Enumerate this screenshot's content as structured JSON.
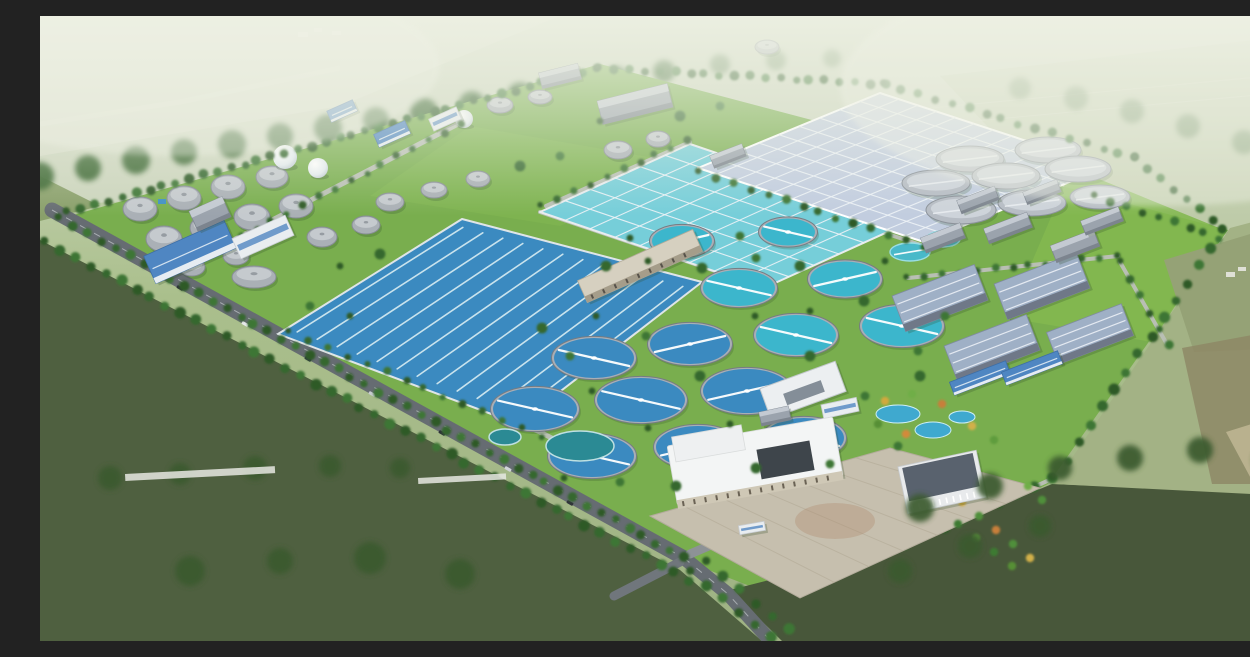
{
  "scene": {
    "label": "Aerial architectural rendering of a large wastewater treatment plant campus surrounded by green farmland",
    "time_of_day": "day",
    "no_visible_text": true
  },
  "colors": {
    "haze": "#eef1e4",
    "distant_field": "#ccd5bd",
    "distant_field2": "#d6dcc8",
    "right_far": "#bfcbaa",
    "site_grass": "#79ae4e",
    "lawn": "#83b850",
    "field_dark_left": "#4f6040",
    "field_dark_right": "#48573a",
    "field_right": "#a3b285",
    "farm_rows": "#95a276",
    "brown_field": "#8e8866",
    "tan_field": "#c0b794",
    "road_dark": "#666c72",
    "road_mid": "#8d9296",
    "road_light": "#b9bfb4",
    "water_blue": "#3b8ac0",
    "water_cyan": "#3cb6cc",
    "aeration": "#76ced9",
    "covered_roof": "#c2cddf",
    "pond_teal": "#2b8a94",
    "garden_pond": "#3fa9cf",
    "tank_gray": "#aab0b6",
    "tank_dome": "#c6cbd0",
    "tank_flat": "#b6bcc4",
    "tank_flat_top": "#cdd3da",
    "sphere": "#eef2f4",
    "roof_blue": "#4f86c2",
    "bld_white": "#e9edf0",
    "bld_gray": "#9ba3ad",
    "bld_beige": "#d6d0c0",
    "workshop_roof": "#9fb0c6",
    "admin_roof": "#f3f5f5",
    "admin_dark_roof": "#59626e",
    "plaza": "#c6bfae",
    "tree_a": "#2d5a28",
    "tree_b": "#35682e",
    "tree_c": "#3e7634",
    "clump": "#39652f",
    "clump_front": "#3a5a2e"
  },
  "background_back": [
    {
      "name": "distant-band",
      "pts": "0,0 1250,0 1250,120 0,190",
      "fill": "#ccd5bd",
      "op": 1
    },
    {
      "name": "distant-topleft",
      "pts": "0,0 520,0 300,90 0,140",
      "fill": "#d6dcc8",
      "op": 1
    },
    {
      "name": "distant-right",
      "pts": "900,60 1250,20 1250,240 1060,230",
      "fill": "#bfcbaa",
      "op": 0.9
    },
    {
      "name": "midleft-wedge",
      "pts": "0,160 60,190 0,205",
      "fill": "#8aa06b",
      "op": 1
    }
  ],
  "background_front": [
    {
      "name": "field-left",
      "pts": "0,224 640,554 722,625 0,625",
      "fill": "#4f6040",
      "op": 1
    },
    {
      "name": "field-bottom-right",
      "pts": "742,625 690,574 864,530 1012,468 1250,478 1250,625",
      "fill": "#48573a",
      "op": 1
    },
    {
      "name": "field-right",
      "pts": "1190,212 1250,196 1250,480 1014,468",
      "fill": "#a3b285",
      "op": 1
    },
    {
      "name": "farm-rows",
      "pts": "1124,244 1250,206 1250,332 1154,336",
      "fill": "#95a276",
      "op": 1
    },
    {
      "name": "field-brown",
      "pts": "1142,332 1250,312 1250,468 1172,468",
      "fill": "#8e8866",
      "op": 0.85
    },
    {
      "name": "field-tan",
      "pts": "1186,416 1250,396 1250,470 1216,472",
      "fill": "#c0b794",
      "op": 0.85
    }
  ],
  "site": {
    "pts": "30,200 560,48 1188,214 1008,468 756,588 648,546",
    "fill": "#79ae4e"
  },
  "lawns": [
    {
      "pts": "1032,152 1184,214 1112,326 968,302",
      "fill": "#83b850",
      "op": 0.9
    },
    {
      "pts": "430,110 660,150 520,210 330,180",
      "fill": "#84b751",
      "op": 0.5
    }
  ],
  "light_roads": [
    {
      "pts": [
        [
          120,
          262
        ],
        [
          422,
          106
        ]
      ],
      "w": 5
    },
    {
      "pts": [
        [
          252,
          312
        ],
        [
          500,
          416
        ],
        [
          562,
          448
        ]
      ],
      "w": 5
    },
    {
      "pts": [
        [
          500,
          196
        ],
        [
          726,
          272
        ]
      ],
      "w": 4
    },
    {
      "pts": [
        [
          506,
          190
        ],
        [
          650,
          126
        ]
      ],
      "w": 4
    },
    {
      "pts": [
        [
          660,
          156
        ],
        [
          884,
          230
        ]
      ],
      "w": 4
    },
    {
      "pts": [
        [
          868,
          262
        ],
        [
          1078,
          240
        ]
      ],
      "w": 4
    },
    {
      "pts": [
        [
          1080,
          246
        ],
        [
          1128,
          330
        ]
      ],
      "w": 4
    },
    {
      "pts": [
        [
          866,
          528
        ],
        [
          1014,
          462
        ]
      ],
      "w": 4
    }
  ],
  "dark_roads": [
    {
      "pts": [
        [
          12,
          194
        ],
        [
          644,
          542
        ]
      ],
      "w": 15,
      "c": "#666c72",
      "dash": true
    },
    {
      "pts": [
        [
          644,
          542
        ],
        [
          688,
          578
        ],
        [
          728,
          622
        ]
      ],
      "w": 14,
      "c": "#666c72",
      "dash": true
    },
    {
      "pts": [
        [
          650,
          538
        ],
        [
          706,
          514
        ]
      ],
      "w": 9,
      "c": "#8d9296",
      "dash": false
    },
    {
      "pts": [
        [
          640,
          546
        ],
        [
          574,
          580
        ]
      ],
      "w": 9,
      "c": "#70767c",
      "dash": false
    }
  ],
  "cars": [
    [
      140,
      272
    ],
    [
      205,
      308
    ],
    [
      268,
      343
    ],
    [
      332,
      378
    ],
    [
      402,
      417
    ],
    [
      468,
      453
    ],
    [
      530,
      487
    ]
  ],
  "car_colors": [
    "#2e3238",
    "#e8eaec",
    "#303840",
    "#c8ccd0",
    "#2e3238",
    "#d0d4d8",
    "#30343a"
  ],
  "basins": [
    {
      "name": "oxidation-ditch-basin",
      "quad": [
        [
          238,
          318
        ],
        [
          422,
          203
        ],
        [
          662,
          266
        ],
        [
          478,
          408
        ]
      ],
      "fill": "#3b8ac0",
      "style": "serpentine",
      "n": 12,
      "rim": "#dfe5e8"
    },
    {
      "name": "aeration-basin",
      "quad": [
        [
          500,
          196
        ],
        [
          650,
          128
        ],
        [
          874,
          204
        ],
        [
          724,
          272
        ]
      ],
      "fill": "#76ced9",
      "style": "grid",
      "n1": 6,
      "n2": 9,
      "rim": "#e8ecef"
    },
    {
      "name": "covered-basin",
      "quad": [
        [
          658,
          152
        ],
        [
          840,
          77
        ],
        [
          1066,
          151
        ],
        [
          884,
          226
        ]
      ],
      "fill": "#c2cddf",
      "style": "grid",
      "n1": 9,
      "n2": 12,
      "rim": "#ffffff"
    }
  ],
  "gray_tanks": [
    [
      100,
      193,
      17,
      12
    ],
    [
      144,
      182,
      17,
      12
    ],
    [
      188,
      171,
      17,
      12
    ],
    [
      232,
      161,
      16,
      11
    ],
    [
      124,
      223,
      18,
      13
    ],
    [
      168,
      212,
      18,
      13
    ],
    [
      212,
      201,
      18,
      13
    ],
    [
      256,
      190,
      17,
      12
    ],
    [
      152,
      251,
      13,
      9
    ],
    [
      196,
      240,
      13,
      9
    ],
    [
      282,
      221,
      15,
      10
    ],
    [
      326,
      209,
      14,
      9
    ],
    [
      350,
      186,
      14,
      9
    ],
    [
      394,
      174,
      13,
      8
    ],
    [
      438,
      163,
      12,
      8
    ],
    [
      460,
      89,
      13,
      8
    ],
    [
      500,
      81,
      12,
      7
    ],
    [
      727,
      31,
      12,
      7
    ],
    [
      578,
      134,
      14,
      9
    ],
    [
      618,
      123,
      12,
      8
    ],
    [
      214,
      261,
      22,
      11
    ]
  ],
  "flat_tanks": [
    [
      930,
      143,
      34,
      13
    ],
    [
      1008,
      134,
      33,
      13
    ],
    [
      896,
      167,
      34,
      13
    ],
    [
      966,
      160,
      34,
      13
    ],
    [
      1038,
      153,
      33,
      13
    ],
    [
      921,
      194,
      35,
      14
    ],
    [
      992,
      187,
      34,
      13
    ],
    [
      1060,
      181,
      30,
      12
    ]
  ],
  "cyan_tanks": [
    [
      870,
      236,
      20,
      9
    ],
    [
      903,
      223,
      17,
      8
    ]
  ],
  "spheres": [
    [
      245,
      141,
      12
    ],
    [
      278,
      152,
      10
    ],
    [
      424,
      103,
      9
    ]
  ],
  "clarifiers": [
    [
      642,
      225,
      30,
      "c"
    ],
    [
      748,
      216,
      27,
      "c"
    ],
    [
      699,
      272,
      36,
      "c"
    ],
    [
      805,
      263,
      35,
      "c"
    ],
    [
      756,
      319,
      40,
      "c"
    ],
    [
      862,
      310,
      40,
      "c"
    ],
    [
      650,
      328,
      40,
      "b"
    ],
    [
      554,
      342,
      40,
      "b"
    ],
    [
      601,
      384,
      44,
      "b"
    ],
    [
      707,
      375,
      44,
      "b"
    ],
    [
      495,
      393,
      42,
      "b"
    ],
    [
      552,
      440,
      42,
      "b"
    ],
    [
      658,
      431,
      42,
      "b"
    ],
    [
      764,
      422,
      40,
      "b"
    ]
  ],
  "buildings": [
    [
      150,
      236,
      88,
      30,
      -24,
      "blue"
    ],
    [
      223,
      221,
      58,
      22,
      -24,
      "white"
    ],
    [
      170,
      198,
      36,
      22,
      -24,
      "gray"
    ],
    [
      352,
      118,
      34,
      14,
      -24,
      "blue"
    ],
    [
      405,
      103,
      30,
      13,
      -24,
      "white"
    ],
    [
      302,
      95,
      28,
      12,
      -24,
      "blue"
    ],
    [
      595,
      88,
      72,
      24,
      -14,
      "gray"
    ],
    [
      520,
      60,
      40,
      16,
      -14,
      "gray"
    ],
    [
      600,
      250,
      126,
      24,
      -24,
      "beige"
    ],
    [
      688,
      140,
      34,
      13,
      -21,
      "gray"
    ],
    [
      763,
      374,
      80,
      32,
      -20,
      "ubld"
    ],
    [
      900,
      282,
      88,
      38,
      -21,
      "workshop"
    ],
    [
      1002,
      270,
      88,
      38,
      -21,
      "workshop"
    ],
    [
      952,
      332,
      88,
      38,
      -21,
      "workshop"
    ],
    [
      1050,
      318,
      80,
      34,
      -21,
      "workshop"
    ],
    [
      1035,
      230,
      46,
      18,
      -21,
      "gray"
    ],
    [
      968,
      212,
      46,
      16,
      -21,
      "gray"
    ],
    [
      903,
      222,
      42,
      16,
      -21,
      "gray"
    ],
    [
      938,
      184,
      40,
      14,
      -21,
      "gray"
    ],
    [
      1002,
      176,
      36,
      13,
      -21,
      "gray"
    ],
    [
      1062,
      205,
      40,
      15,
      -21,
      "gray"
    ],
    [
      940,
      362,
      60,
      14,
      -21,
      "blue"
    ],
    [
      992,
      352,
      60,
      14,
      -21,
      "blue"
    ],
    [
      735,
      400,
      30,
      14,
      -12,
      "gray"
    ],
    [
      800,
      392,
      36,
      14,
      -12,
      "white"
    ],
    [
      715,
      445,
      168,
      60,
      -10,
      "adminW"
    ],
    [
      902,
      466,
      80,
      48,
      -12,
      "adminD"
    ],
    [
      712,
      512,
      26,
      9,
      -10,
      "white"
    ]
  ],
  "plaza": {
    "pts": "610,500 850,432 1000,472 760,582",
    "fill": "#c6bfae",
    "rust": [
      795,
      505,
      40,
      18
    ]
  },
  "ponds": [
    [
      540,
      430,
      34,
      15
    ],
    [
      465,
      421,
      16,
      8
    ]
  ],
  "garden_ponds": [
    [
      858,
      398,
      22,
      9
    ],
    [
      893,
      414,
      18,
      8
    ],
    [
      922,
      401,
      13,
      6
    ]
  ],
  "garden_trees": [
    [
      845,
      385,
      "#d2a93e"
    ],
    [
      872,
      378,
      "#6fae46"
    ],
    [
      902,
      388,
      "#c77f3a"
    ],
    [
      932,
      410,
      "#d2b049"
    ],
    [
      954,
      424,
      "#5f9c3c"
    ],
    [
      866,
      418,
      "#d28a3a"
    ],
    [
      838,
      408,
      "#568f36"
    ],
    [
      905,
      472,
      "#4f8f3a"
    ],
    [
      922,
      486,
      "#d2a93e"
    ],
    [
      939,
      500,
      "#4f8f3a"
    ],
    [
      956,
      514,
      "#c77f3a"
    ],
    [
      973,
      528,
      "#4f8f3a"
    ],
    [
      990,
      542,
      "#d2b049"
    ],
    [
      918,
      508,
      "#3e7a30"
    ],
    [
      936,
      522,
      "#578f3b"
    ],
    [
      954,
      536,
      "#3e7a30"
    ],
    [
      972,
      550,
      "#568f36"
    ],
    [
      988,
      470,
      "#6fae46"
    ],
    [
      1002,
      484,
      "#4f8f3a"
    ]
  ],
  "tree_rows": [
    [
      28,
      196,
      556,
      52,
      40,
      4.5
    ],
    [
      560,
      52,
      845,
      68,
      20,
      4.2
    ],
    [
      845,
      68,
      1096,
      142,
      16,
      4.2
    ],
    [
      1096,
      142,
      1184,
      214,
      8,
      4.2
    ],
    [
      1184,
      214,
      1014,
      462,
      15,
      5
    ],
    [
      1014,
      462,
      866,
      528,
      9,
      5
    ],
    [
      20,
      202,
      644,
      542,
      46,
      4.5
    ],
    [
      6,
      226,
      650,
      564,
      44,
      5
    ],
    [
      652,
      556,
      730,
      622,
      6,
      5
    ],
    [
      668,
      546,
      748,
      614,
      6,
      5
    ],
    [
      122,
      262,
      420,
      108,
      20,
      3.5
    ],
    [
      250,
      316,
      500,
      420,
      14,
      3.5
    ],
    [
      502,
      190,
      648,
      124,
      10,
      3.5
    ],
    [
      660,
      156,
      882,
      230,
      14,
      4
    ],
    [
      868,
      262,
      1076,
      240,
      13,
      3.5
    ],
    [
      1082,
      246,
      1128,
      330,
      6,
      4
    ],
    [
      1056,
      180,
      1180,
      222,
      9,
      4
    ]
  ],
  "tree_scatter": [
    [
      608,
      245
    ],
    [
      662,
      252
    ],
    [
      716,
      242
    ],
    [
      770,
      295
    ],
    [
      824,
      285
    ],
    [
      878,
      335
    ],
    [
      715,
      300
    ],
    [
      660,
      360
    ],
    [
      606,
      320
    ],
    [
      552,
      375
    ],
    [
      770,
      340
    ],
    [
      825,
      380
    ],
    [
      608,
      412
    ],
    [
      716,
      452
    ],
    [
      790,
      448
    ],
    [
      556,
      300
    ],
    [
      502,
      312
    ],
    [
      858,
      430
    ],
    [
      690,
      408
    ],
    [
      636,
      470
    ],
    [
      580,
      466
    ],
    [
      524,
      462
    ],
    [
      880,
      360
    ],
    [
      905,
      300
    ],
    [
      845,
      245
    ],
    [
      760,
      250
    ],
    [
      700,
      220
    ],
    [
      590,
      222
    ],
    [
      566,
      250
    ],
    [
      530,
      340
    ],
    [
      300,
      250
    ],
    [
      340,
      238
    ],
    [
      270,
      290
    ],
    [
      310,
      300
    ],
    [
      480,
      150
    ],
    [
      520,
      140
    ],
    [
      560,
      105
    ],
    [
      640,
      100
    ],
    [
      680,
      90
    ]
  ],
  "tree_clumps_back": [
    [
      0,
      160,
      14,
      0.95
    ],
    [
      48,
      152,
      13,
      0.95
    ],
    [
      96,
      144,
      14,
      0.95
    ],
    [
      144,
      136,
      13,
      0.95
    ],
    [
      192,
      128,
      14,
      0.95
    ],
    [
      240,
      120,
      13,
      0.95
    ],
    [
      288,
      112,
      14,
      0.95
    ],
    [
      336,
      104,
      13,
      0.95
    ],
    [
      384,
      96,
      14,
      0.95
    ],
    [
      432,
      88,
      13,
      0.95
    ],
    [
      480,
      79,
      13,
      0.95
    ],
    [
      528,
      70,
      13,
      0.95
    ],
    [
      576,
      62,
      12,
      0.95
    ],
    [
      624,
      55,
      11,
      0.9
    ],
    [
      680,
      48,
      10,
      0.6
    ],
    [
      736,
      44,
      10,
      0.5
    ],
    [
      792,
      42,
      9,
      0.45
    ],
    [
      980,
      72,
      11,
      0.5
    ],
    [
      1036,
      82,
      12,
      0.5
    ],
    [
      1092,
      95,
      12,
      0.55
    ],
    [
      1148,
      110,
      12,
      0.55
    ],
    [
      1204,
      126,
      12,
      0.5
    ],
    [
      1200,
      300,
      10,
      0.6
    ],
    [
      1235,
      330,
      9,
      0.55
    ]
  ],
  "tree_clumps_front": [
    [
      70,
      462,
      12,
      0.9
    ],
    [
      140,
      458,
      11,
      0.9
    ],
    [
      215,
      452,
      12,
      0.9
    ],
    [
      290,
      450,
      11,
      0.9
    ],
    [
      360,
      452,
      10,
      0.9
    ],
    [
      150,
      555,
      15,
      0.92
    ],
    [
      240,
      545,
      13,
      0.92
    ],
    [
      330,
      542,
      16,
      0.92
    ],
    [
      420,
      558,
      15,
      0.92
    ],
    [
      880,
      492,
      14,
      0.92
    ],
    [
      950,
      470,
      13,
      0.92
    ],
    [
      1020,
      452,
      12,
      0.92
    ],
    [
      1090,
      442,
      13,
      0.92
    ],
    [
      1160,
      434,
      13,
      0.92
    ],
    [
      1225,
      444,
      12,
      0.92
    ],
    [
      930,
      530,
      12,
      0.92
    ],
    [
      1000,
      510,
      11,
      0.92
    ],
    [
      860,
      555,
      12,
      0.9
    ]
  ],
  "greenhouses": [
    [
      85,
      458,
      150,
      7,
      -3
    ],
    [
      378,
      462,
      88,
      6,
      -3
    ]
  ],
  "village_specks": [
    [
      258,
      16,
      10,
      5
    ],
    [
      274,
      12,
      8,
      4
    ],
    [
      292,
      15,
      9,
      4
    ]
  ],
  "farmstead": [
    [
      1186,
      256,
      9,
      5
    ],
    [
      1198,
      251,
      8,
      4
    ]
  ],
  "power_lines": [
    [
      850,
      96,
      1250,
      58
    ],
    [
      858,
      112,
      1250,
      76
    ]
  ],
  "distant_road": "0,108 140,86 300,52",
  "small_pool": [
    118,
    183,
    8,
    5
  ]
}
